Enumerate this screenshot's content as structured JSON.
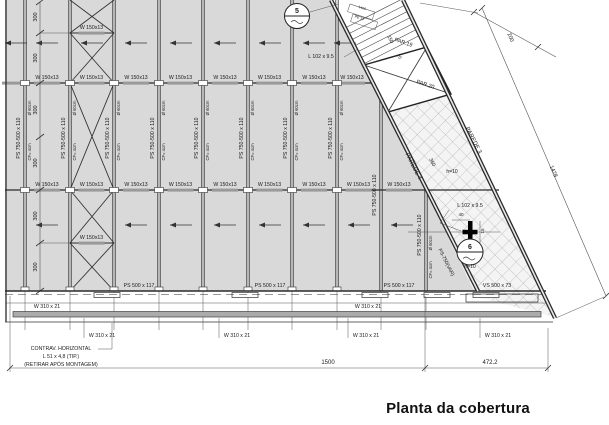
{
  "title": "Planta da cobertura",
  "colors": {
    "roof_fill": "#d9d9d9",
    "eave_band_fill": "#ababab",
    "line": "#2b2b2b",
    "hatch_line": "#979797",
    "text": "#1a1a1a"
  },
  "annotations": [
    {
      "text": "W 150x13",
      "size": 5.2,
      "rot": 0,
      "pos": [
        [
          47,
          79
        ],
        [
          91.5,
          79
        ],
        [
          136,
          79
        ],
        [
          180.5,
          79
        ],
        [
          225,
          79
        ],
        [
          269.5,
          79
        ],
        [
          314,
          79
        ],
        [
          352,
          79
        ],
        [
          47,
          186
        ],
        [
          91.5,
          186
        ],
        [
          136,
          186
        ],
        [
          180.5,
          186
        ],
        [
          225,
          186
        ],
        [
          269.5,
          186
        ],
        [
          314,
          186
        ],
        [
          358.5,
          186
        ],
        [
          399,
          186
        ],
        [
          91.5,
          29
        ],
        [
          91.5,
          239
        ]
      ]
    },
    {
      "text": "PS 750-500 x 110",
      "size": 5.2,
      "rot": -90,
      "pos": [
        [
          20,
          138
        ],
        [
          65,
          138
        ],
        [
          109,
          138
        ],
        [
          154,
          138
        ],
        [
          198,
          138
        ],
        [
          243,
          138
        ],
        [
          287,
          138
        ],
        [
          332,
          138
        ],
        [
          376,
          195
        ],
        [
          421,
          235
        ]
      ]
    },
    {
      "text": "Ø 60cm",
      "size": 4.2,
      "rot": -90,
      "pos": [
        [
          31,
          108
        ],
        [
          76,
          108
        ],
        [
          120,
          108
        ],
        [
          165,
          108
        ],
        [
          209,
          108
        ],
        [
          254,
          108
        ],
        [
          298,
          108
        ],
        [
          343,
          108
        ],
        [
          432,
          243
        ]
      ]
    },
    {
      "text": "CF= 4cm",
      "size": 4.2,
      "rot": -90,
      "pos": [
        [
          31,
          152
        ],
        [
          76,
          152
        ],
        [
          120,
          152
        ],
        [
          165,
          152
        ],
        [
          209,
          152
        ],
        [
          254,
          152
        ],
        [
          298,
          152
        ],
        [
          343,
          152
        ],
        [
          432,
          270
        ]
      ]
    },
    {
      "text": "PS 500 x 117",
      "size": 5.2,
      "rot": 0,
      "pos": [
        [
          139,
          287
        ],
        [
          270,
          287
        ],
        [
          399,
          287
        ]
      ]
    },
    {
      "text": "VS 500 x 73",
      "size": 5.2,
      "rot": 0,
      "pos": [
        [
          497,
          287
        ]
      ]
    },
    {
      "text": "W 310 x 21",
      "size": 5.2,
      "rot": 0,
      "pos": [
        [
          47,
          308
        ],
        [
          368,
          308
        ],
        [
          102,
          337
        ],
        [
          237,
          337
        ],
        [
          366,
          337
        ],
        [
          498,
          337
        ]
      ]
    },
    {
      "text": "300",
      "size": 5.5,
      "rot": -90,
      "pos": [
        [
          37,
          17
        ],
        [
          37,
          58
        ],
        [
          37,
          110
        ],
        [
          37,
          163
        ],
        [
          37,
          216
        ],
        [
          37,
          267
        ]
      ]
    },
    {
      "text": "1500",
      "size": 6,
      "rot": 0,
      "pos": [
        [
          328,
          364
        ]
      ]
    },
    {
      "text": "472.2",
      "size": 6,
      "rot": 0,
      "pos": [
        [
          490,
          364
        ]
      ]
    },
    {
      "text": "1478",
      "size": 5.5,
      "rot": 67,
      "pos": [
        [
          552,
          172
        ]
      ]
    },
    {
      "text": "200",
      "size": 5.5,
      "rot": 67,
      "pos": [
        [
          509,
          38
        ]
      ]
    },
    {
      "text": "150",
      "size": 5,
      "rot": 63,
      "pos": [
        [
          389,
          40
        ]
      ]
    },
    {
      "text": "20",
      "size": 4.5,
      "rot": 63,
      "pos": [
        [
          398,
          57
        ]
      ]
    },
    {
      "text": "360",
      "size": 5,
      "rot": 63,
      "pos": [
        [
          431,
          163
        ]
      ]
    },
    {
      "text": "40",
      "size": 4.5,
      "rot": 0,
      "pos": [
        [
          461,
          216
        ]
      ]
    },
    {
      "text": "15",
      "size": 4.5,
      "rot": -90,
      "pos": [
        [
          484,
          231
        ]
      ]
    },
    {
      "text": "L 102 x 9.5",
      "size": 5.2,
      "rot": 0,
      "pos": [
        [
          321,
          58
        ],
        [
          470,
          207
        ]
      ]
    },
    {
      "text": "PAREDE 4",
      "size": 6,
      "rot": 63,
      "pos": [
        [
          412,
          167
        ]
      ]
    },
    {
      "text": "PAREDE 3",
      "size": 6,
      "rot": 63,
      "pos": [
        [
          472,
          141
        ]
      ]
    },
    {
      "text": "PS-750(VAR)",
      "size": 5,
      "rot": 63,
      "pos": [
        [
          445,
          263
        ]
      ]
    },
    {
      "text": "PAR.19",
      "size": 5.5,
      "rot": 18,
      "pos": [
        [
          403,
          44
        ]
      ]
    },
    {
      "text": "PAR.20",
      "size": 5.5,
      "rot": 18,
      "pos": [
        [
          425,
          86
        ]
      ]
    },
    {
      "text": "1460",
      "size": 3.5,
      "rot": 18,
      "pos": [
        [
          362,
          9
        ]
      ]
    },
    {
      "text": "PE 14",
      "size": 3.5,
      "rot": 18,
      "pos": [
        [
          359,
          19
        ]
      ]
    },
    {
      "text": "h=10",
      "size": 5,
      "rot": 0,
      "pos": [
        [
          452,
          173
        ],
        [
          470,
          268
        ]
      ]
    },
    {
      "text": "5",
      "size": 7,
      "rot": 0,
      "bold": true,
      "pos": [
        [
          297,
          13
        ]
      ]
    },
    {
      "text": "6",
      "size": 7,
      "rot": 0,
      "bold": true,
      "pos": [
        [
          470,
          249
        ]
      ]
    },
    {
      "text": "CONTRAV. HORIZONTAL",
      "size": 5.2,
      "rot": 0,
      "pos": [
        [
          61,
          350
        ]
      ]
    },
    {
      "text": "L 51 x 4,8 (TIP.)",
      "size": 5.2,
      "rot": 0,
      "pos": [
        [
          61,
          358
        ]
      ]
    },
    {
      "text": "(RETIRAR APÓS MONTAGEM)",
      "size": 5.2,
      "rot": 0,
      "pos": [
        [
          61,
          366
        ]
      ]
    }
  ]
}
